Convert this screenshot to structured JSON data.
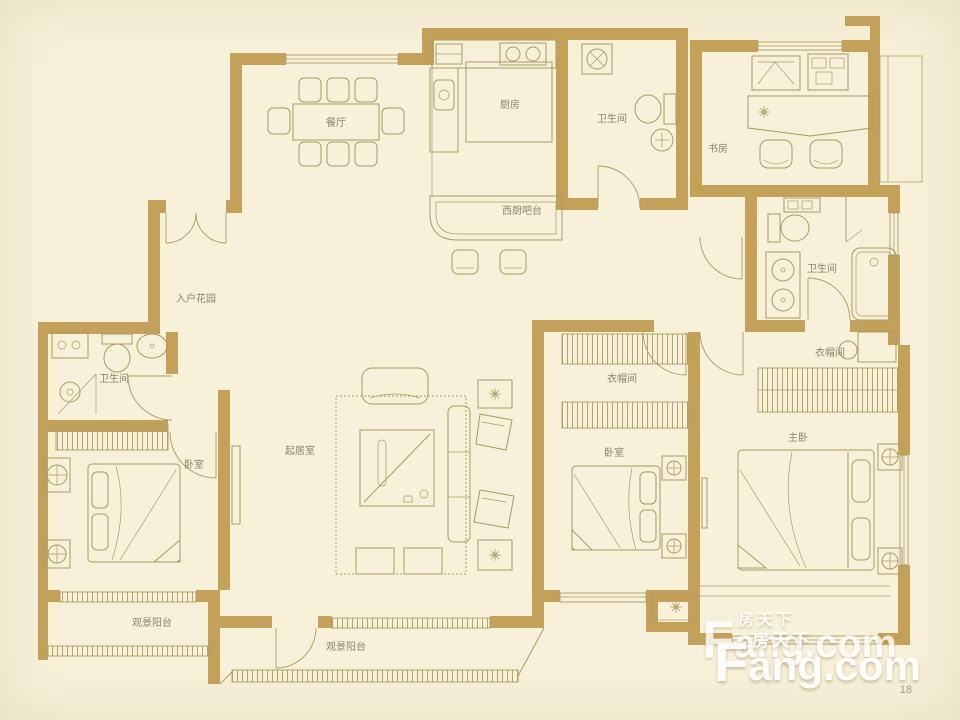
{
  "colors": {
    "background": "#f7f1d9",
    "wall": "#c4a159",
    "line": "#a99a63",
    "label": "#8d8468",
    "watermark": "#ffffff",
    "page_number_color": "#a49c82"
  },
  "floorplan": {
    "labels": {
      "dining": "餐厅",
      "kitchen": "厨房",
      "public_bath": "卫生间",
      "study": "书房",
      "west_kitchen": "西厨吧台",
      "entry_garden": "入户花园",
      "left_bath": "卫生间",
      "left_bedroom": "卧室",
      "living_room": "起居室",
      "middle_closet": "衣帽间",
      "middle_bedroom": "卧室",
      "master_bath": "卫生间",
      "master_closet": "衣帽间",
      "master_bedroom": "主卧",
      "left_balcony": "观景阳台",
      "center_balcony": "观景阳台"
    }
  },
  "watermark": {
    "f": "F",
    "rest": "ang.com",
    "cn": "房天下",
    "page_number": "18"
  }
}
